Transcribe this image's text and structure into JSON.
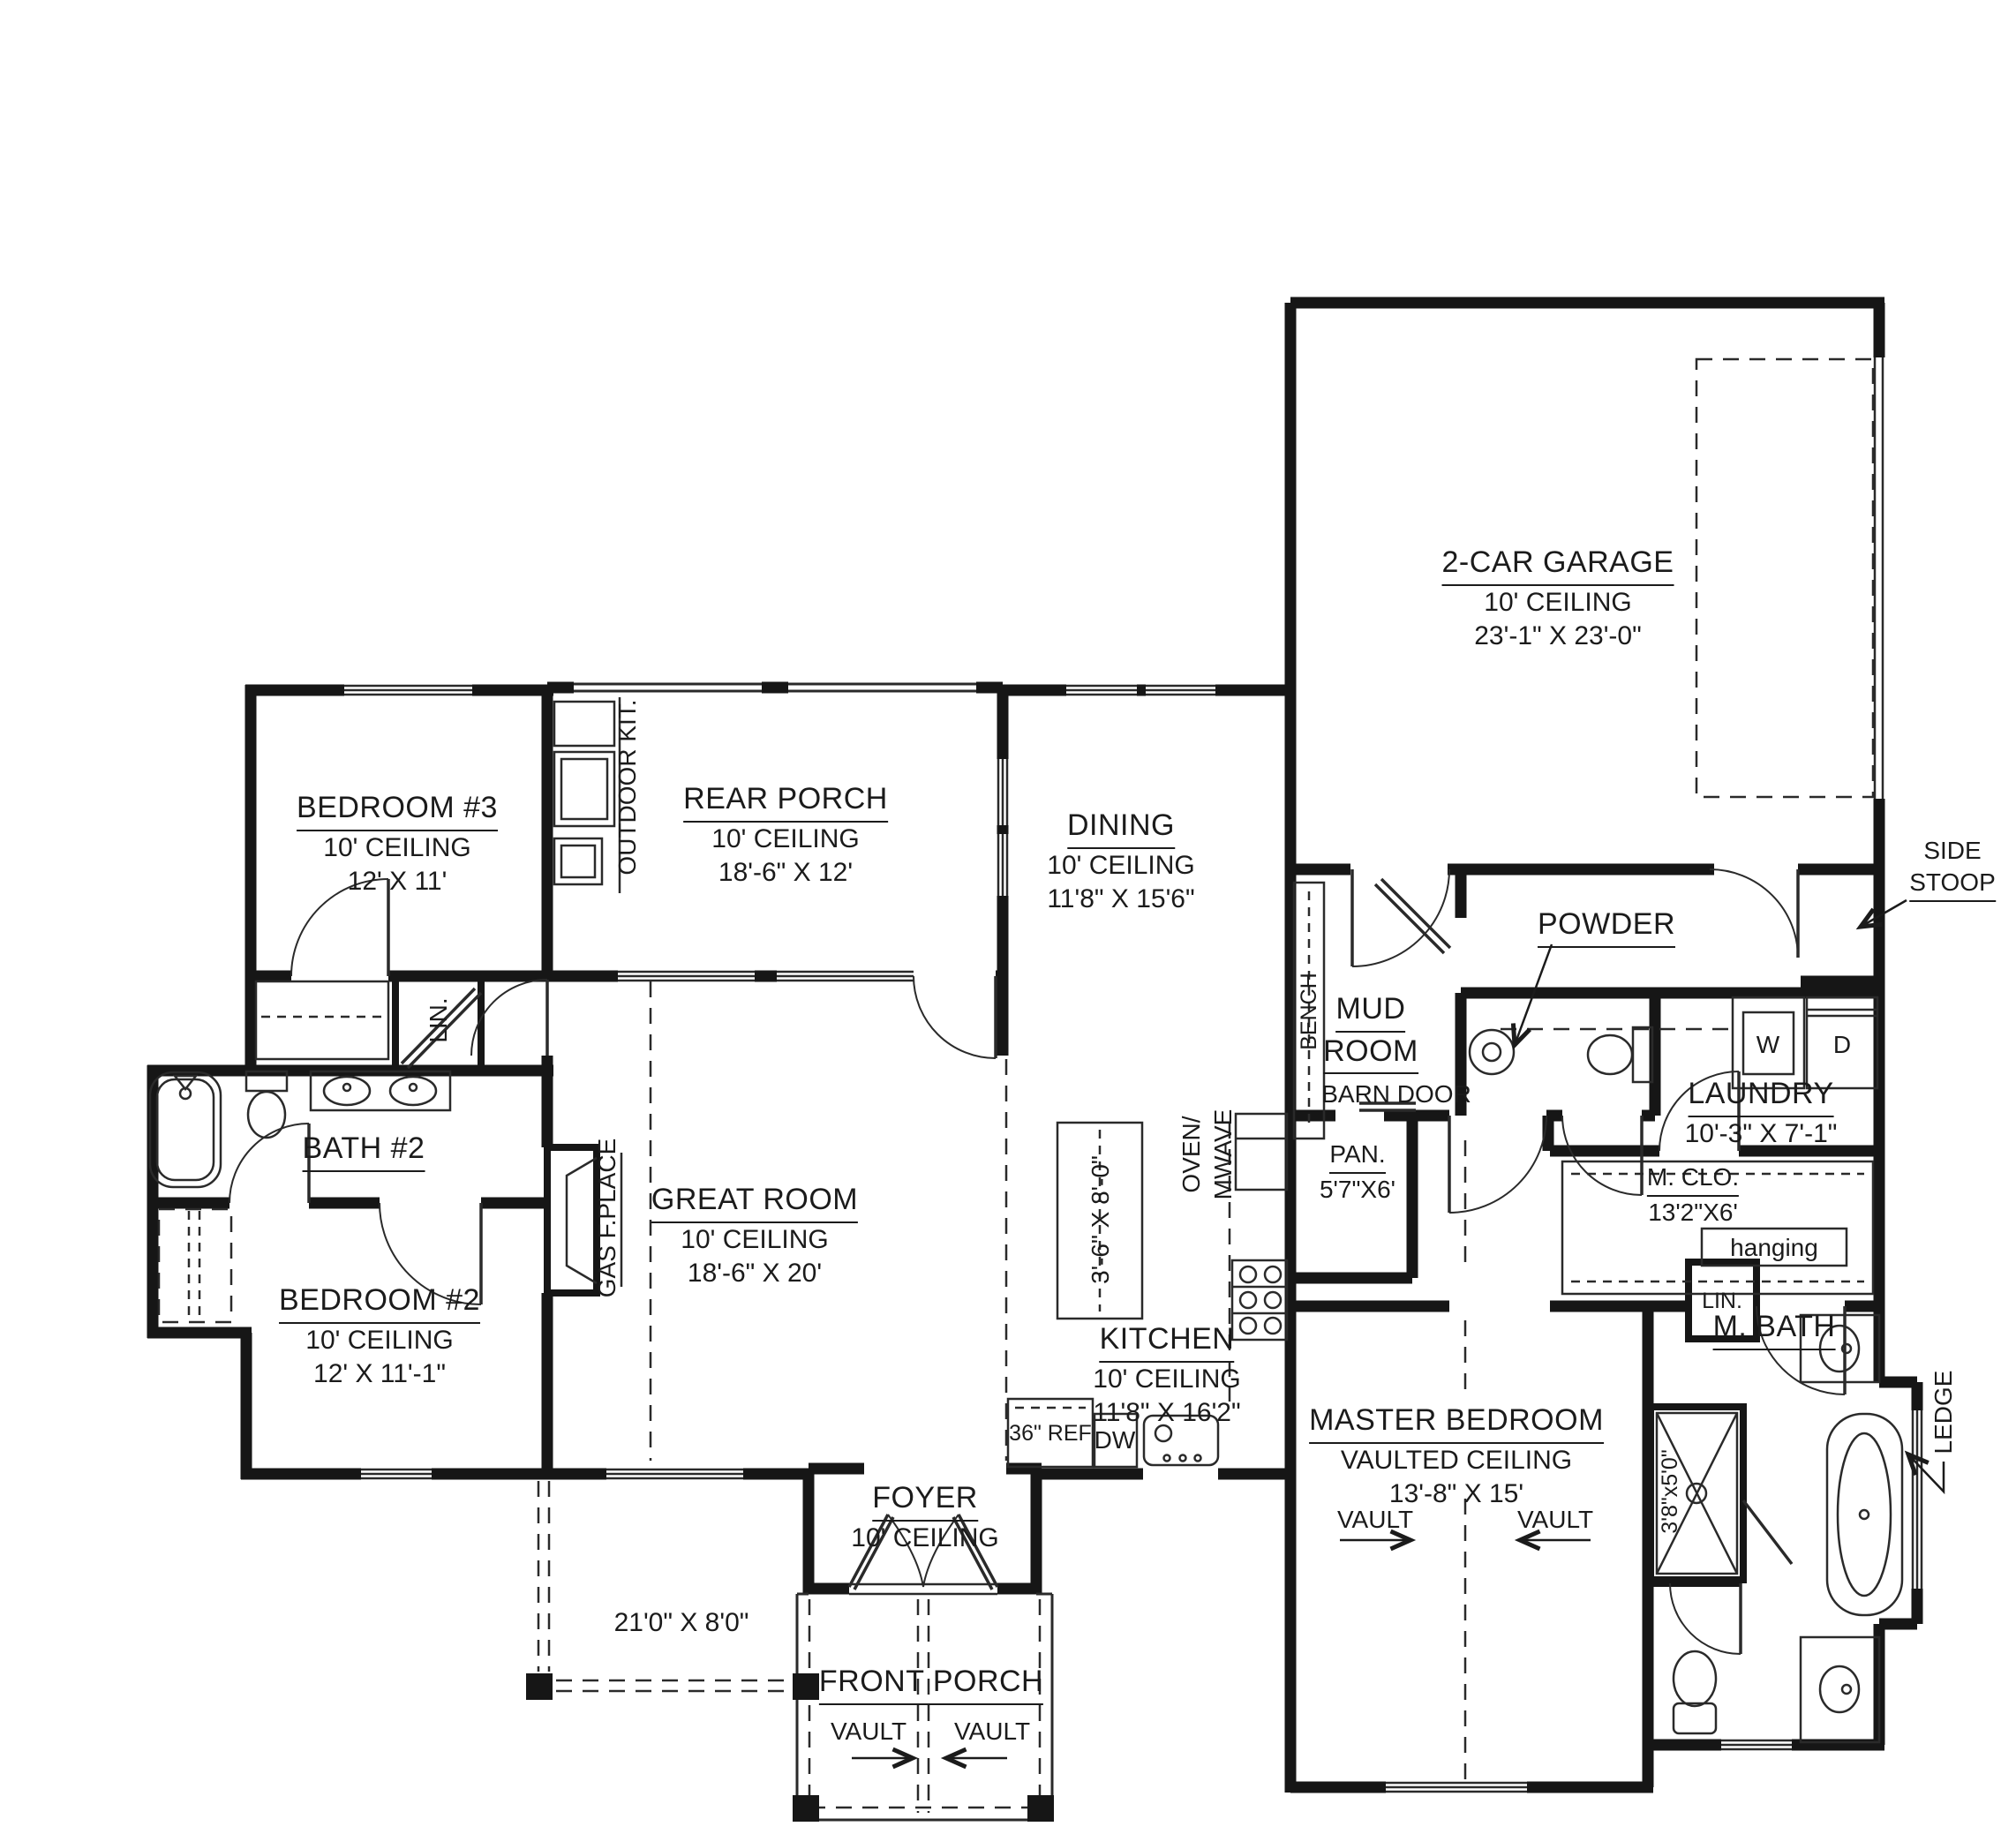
{
  "rooms": {
    "garage": {
      "name": "2-CAR GARAGE",
      "l2": "10' CEILING",
      "l3": "23'-1\" X 23'-0\""
    },
    "bedroom3": {
      "name": "BEDROOM #3",
      "l2": "10' CEILING",
      "l3": "12' X 11'"
    },
    "rear_porch": {
      "name": "REAR PORCH",
      "l2": "10' CEILING",
      "l3": "18'-6\" X 12'"
    },
    "dining": {
      "name": "DINING",
      "l2": "10' CEILING",
      "l3": "11'8\" X 15'6\""
    },
    "great_room": {
      "name": "GREAT ROOM",
      "l2": "10' CEILING",
      "l3": "18'-6\" X 20'"
    },
    "kitchen": {
      "name": "KITCHEN",
      "l2": "10' CEILING",
      "l3": "11'8\" X 16'2\""
    },
    "bedroom2": {
      "name": "BEDROOM #2",
      "l2": "10' CEILING",
      "l3": "12' X 11'-1\""
    },
    "master": {
      "name": "MASTER BEDROOM",
      "l2": "VAULTED CEILING",
      "l3": "13'-8\" X 15'"
    },
    "foyer": {
      "name": "FOYER",
      "l2": "10' CEILING"
    },
    "front_porch": {
      "name": "FRONT PORCH"
    },
    "bath2": {
      "name": "BATH #2"
    },
    "mud": {
      "name_1": "MUD",
      "name_2": "ROOM"
    },
    "powder": {
      "name": "POWDER"
    },
    "laundry": {
      "name": "LAUNDRY",
      "l2": "10'-3\" X 7'-1\""
    },
    "pantry": {
      "name": "PAN.",
      "l2": "5'7\"X6'"
    },
    "master_closet": {
      "name": "M. CLO.",
      "l2": "13'2\"X6'"
    },
    "master_bath": {
      "name": "M. BATH"
    },
    "side_stoop": {
      "name_1": "SIDE",
      "name_2": "STOOP"
    }
  },
  "annotations": {
    "barn_door": "BARN DOOR",
    "bench": "BENCH",
    "outdoor_kitchen": "OUTDOOR KIT.",
    "gas_fireplace": "GAS F.PLACE",
    "island_dims": "3'-6\" X 8'-0\"",
    "oven_1": "OVEN/",
    "oven_2": "MWAVE",
    "fridge": "36\" REF",
    "dishwasher": "DW",
    "washer": "W",
    "dryer": "D",
    "hanging": "hanging",
    "linen_hall": "LIN.",
    "linen_master": "LIN.",
    "shower_dims": "3'8\"x5'0\"",
    "ledge": "LEDGE",
    "porch_dims": "21'0\" X 8'0\"",
    "vault": "VAULT"
  },
  "colors": {
    "walls": "#161616",
    "text": "#1b1b1b",
    "background": "#ffffff"
  }
}
